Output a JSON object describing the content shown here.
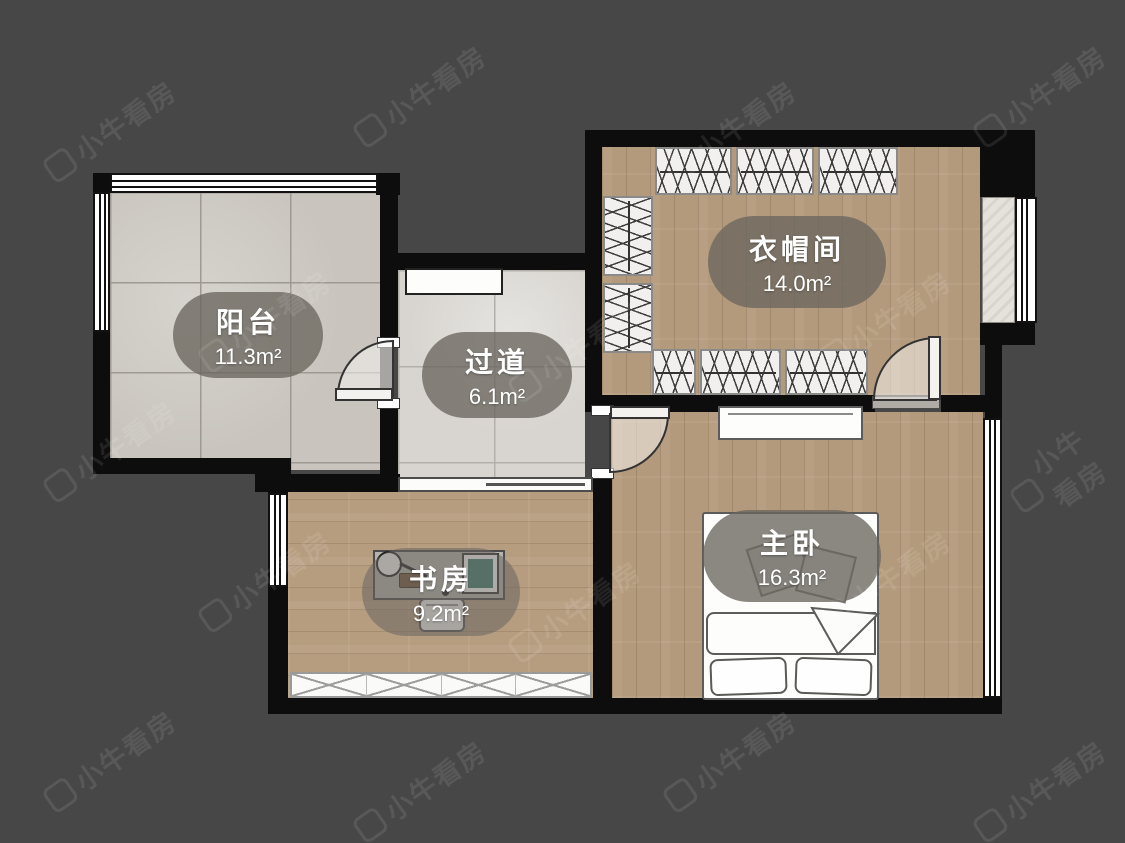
{
  "app": {
    "watermark_text": "小牛看房"
  },
  "floorplan": {
    "rooms": [
      {
        "id": "balcony",
        "name": "阳台",
        "area": "11.3m²"
      },
      {
        "id": "hallway",
        "name": "过道",
        "area": "6.1m²"
      },
      {
        "id": "cloakroom",
        "name": "衣帽间",
        "area": "14.0m²"
      },
      {
        "id": "study",
        "name": "书房",
        "area": "9.2m²"
      },
      {
        "id": "master-bedroom",
        "name": "主卧",
        "area": "16.3m²"
      }
    ],
    "colors": {
      "background": "#474747",
      "wall": "#0d0d0d",
      "wood_floor": "#b49a7c",
      "tile_floor": "#c9c5be",
      "marble_floor": "#d8d5d0",
      "label_bg": "rgba(106,101,94,0.78)",
      "label_text": "#ffffff"
    }
  }
}
